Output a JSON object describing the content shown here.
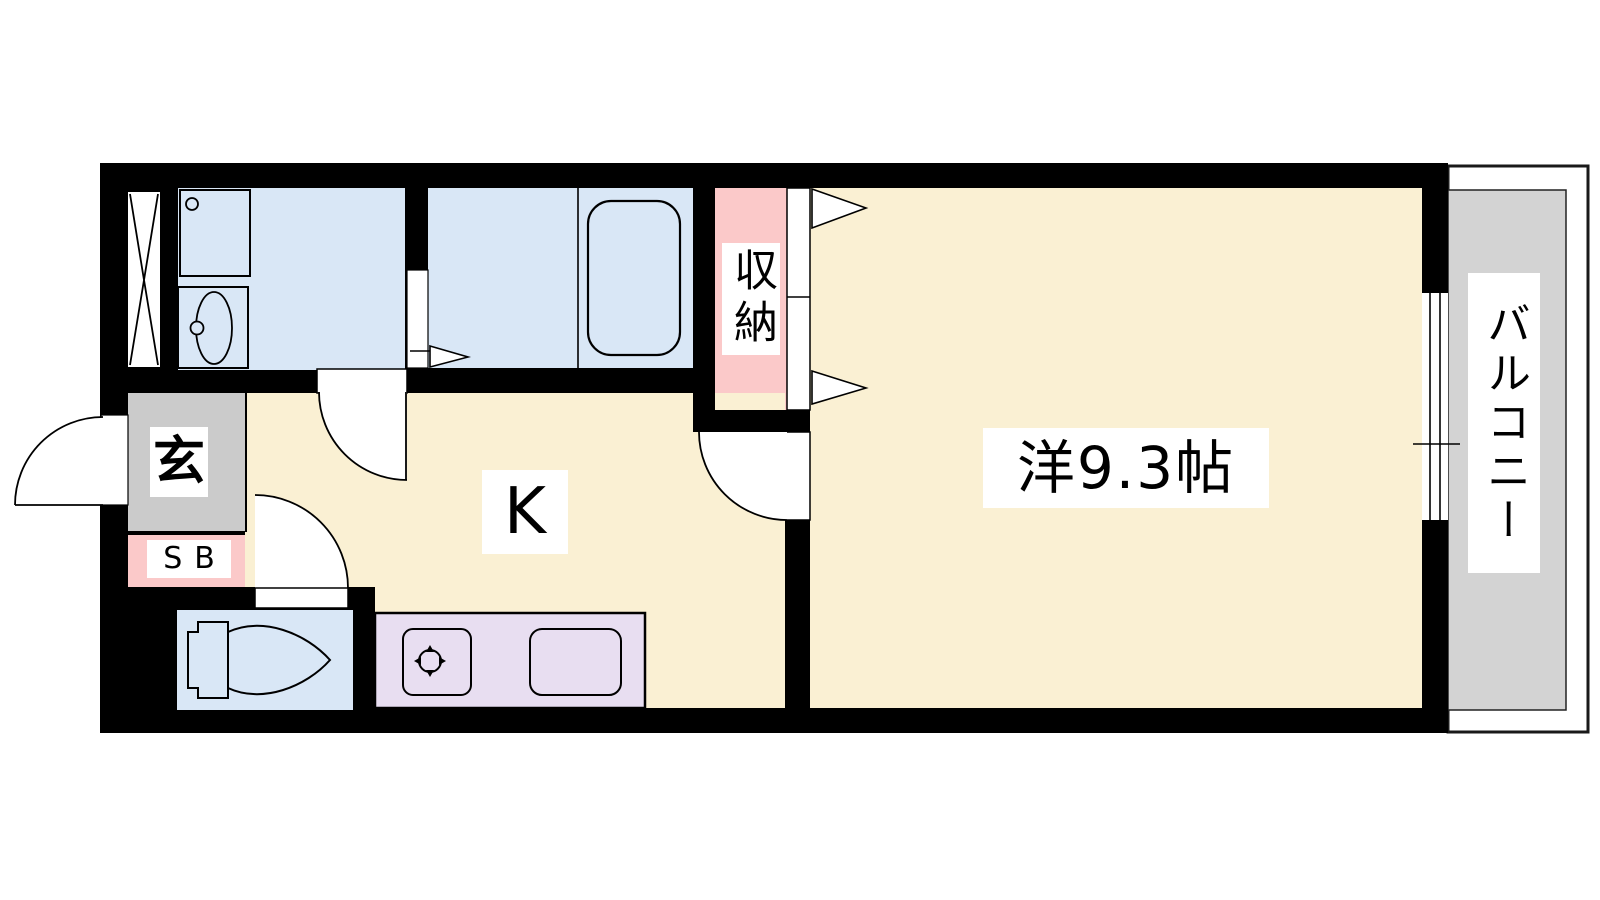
{
  "floor_plan": {
    "labels": {
      "entrance": "玄",
      "shoe_box": "SB",
      "closet": "収納",
      "kitchen": "K",
      "main_room": "洋9.3帖",
      "balcony": "バルコニー"
    },
    "colors": {
      "wall": "#000000",
      "floor_cream": "#FAF0D3",
      "wet_area_blue": "#D9E7F6",
      "closet_pink": "#FBC9C9",
      "counter_lavender": "#E8DEF1",
      "entrance_gray": "#CBCBCB",
      "balcony_gray": "#D3D3D3",
      "label_background": "#FFFFFF"
    }
  }
}
